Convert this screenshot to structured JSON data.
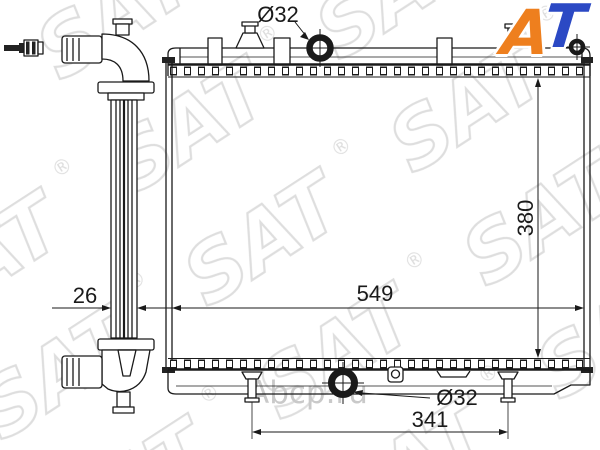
{
  "logo": {
    "letter_a": "A",
    "letter_t": "T",
    "color_a": "#ee7f1e",
    "color_t": "#2b49c4"
  },
  "watermark": {
    "tile": "SAT",
    "reg": "®",
    "site": "Abcp.ru",
    "tile_color": "#dedede",
    "site_color": "#c9c9c9"
  },
  "drawing": {
    "line_color": "#1a1a1a"
  },
  "labels": {
    "inlet_diameter": "Ø32",
    "outlet_diameter": "Ø32",
    "core_width": "549",
    "core_height": "380",
    "core_thickness": "26",
    "mount_spacing": "341"
  }
}
